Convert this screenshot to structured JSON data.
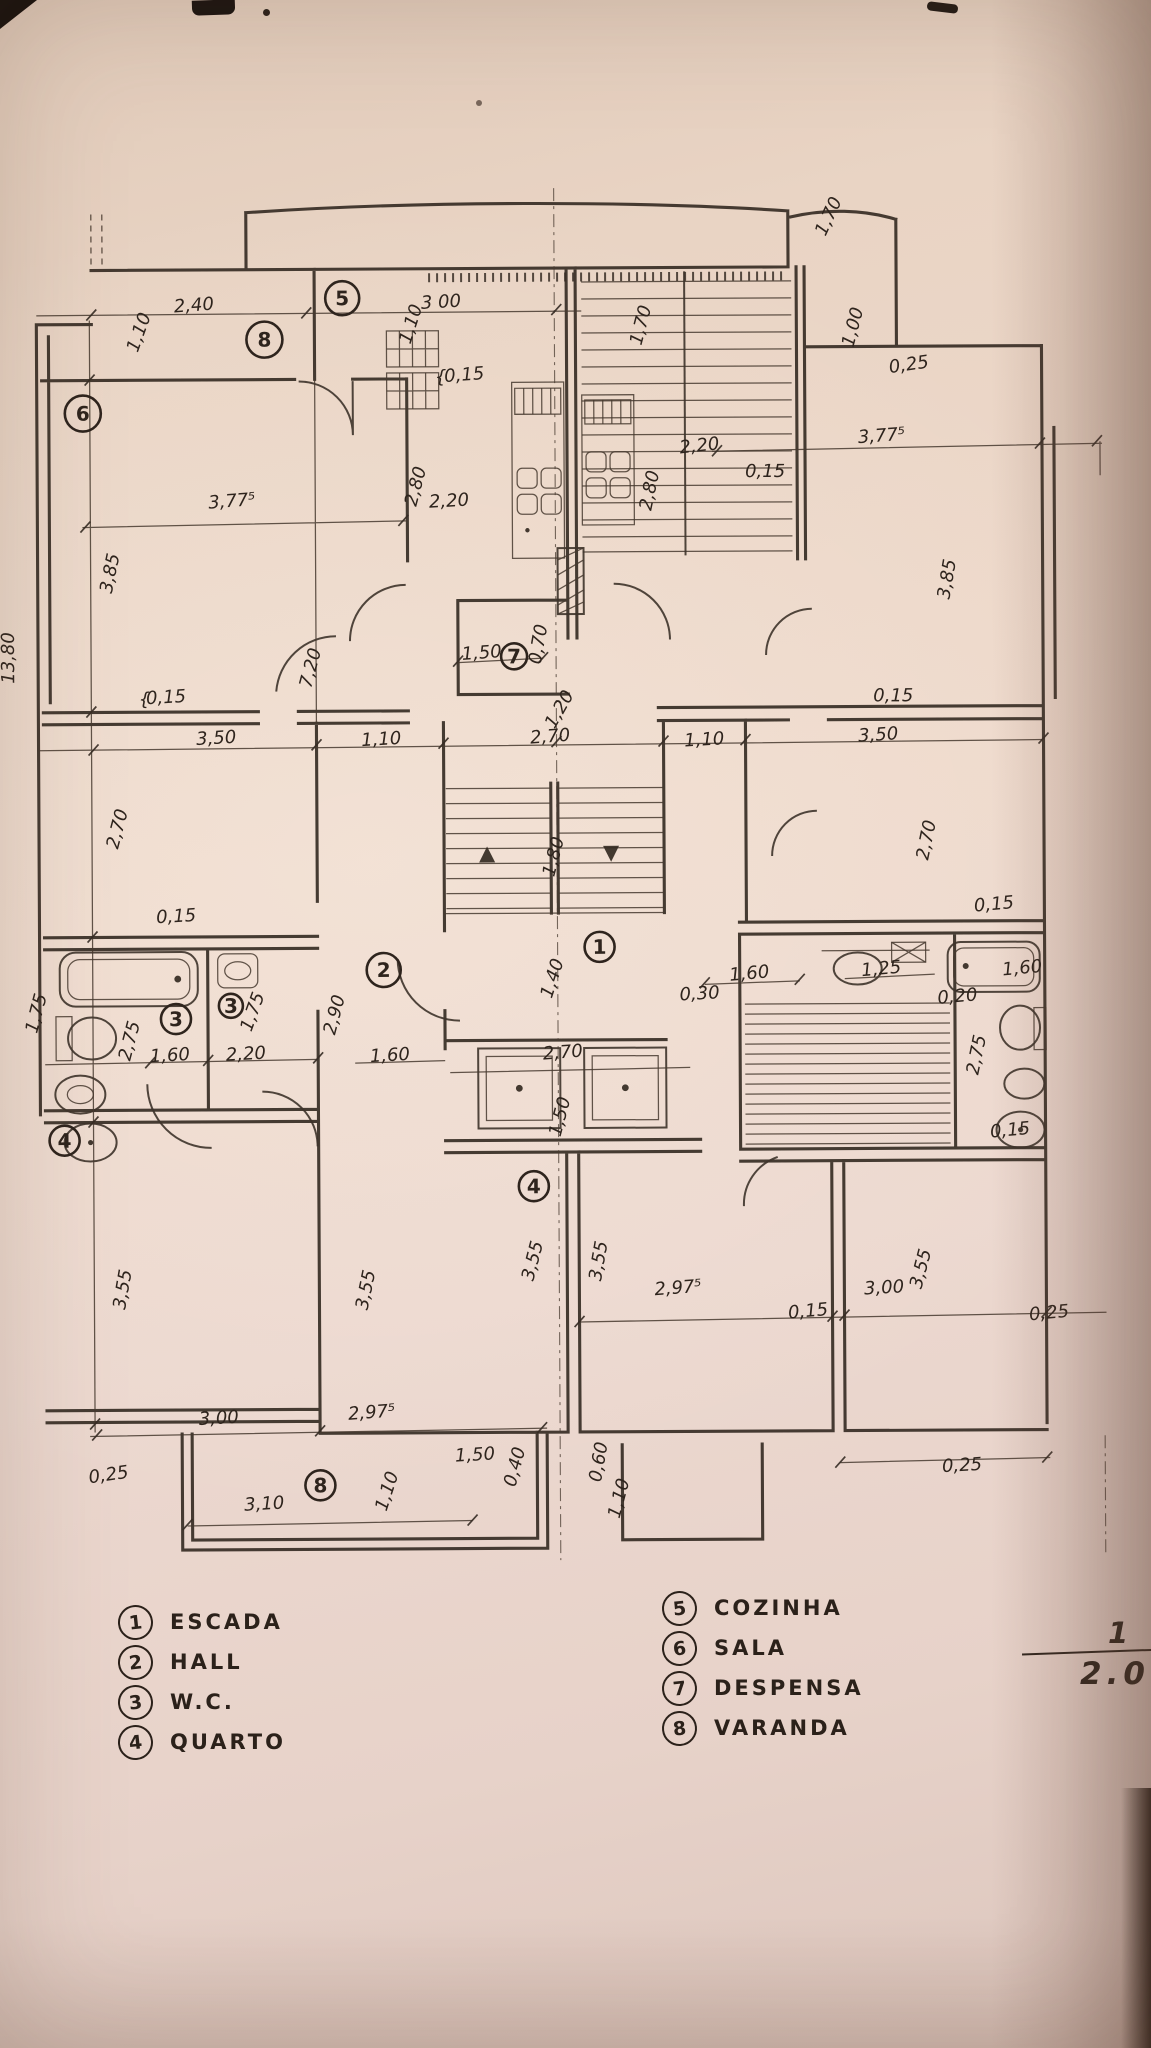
{
  "colors": {
    "paper": "#ecd8cb",
    "ink": "#342a22",
    "shadow": "#8a5f4e"
  },
  "legend": {
    "left": [
      {
        "num": "1",
        "label": "ESCADA"
      },
      {
        "num": "2",
        "label": "HALL"
      },
      {
        "num": "3",
        "label": "W.C."
      },
      {
        "num": "4",
        "label": "QUARTO"
      }
    ],
    "right": [
      {
        "num": "5",
        "label": "COZINHA"
      },
      {
        "num": "6",
        "label": "SALA"
      },
      {
        "num": "7",
        "label": "DESPENSA"
      },
      {
        "num": "8",
        "label": "VARANDA"
      }
    ]
  },
  "scale": {
    "numerator": "1",
    "denominator": "2.000"
  },
  "plan": {
    "room_markers": [
      {
        "num": "5",
        "x": 346,
        "y": 297,
        "s": 17
      },
      {
        "num": "8",
        "x": 268,
        "y": 338,
        "s": 18
      },
      {
        "num": "6",
        "x": 86,
        "y": 411,
        "s": 18
      },
      {
        "num": "7",
        "x": 516,
        "y": 656,
        "s": 13
      },
      {
        "num": "2",
        "x": 384,
        "y": 969,
        "s": 17
      },
      {
        "num": "1",
        "x": 600,
        "y": 947,
        "s": 15
      },
      {
        "num": "3",
        "x": 176,
        "y": 1017,
        "s": 15
      },
      {
        "num": "3",
        "x": 231,
        "y": 1004,
        "s": 12
      },
      {
        "num": "4",
        "x": 64,
        "y": 1138,
        "s": 15
      },
      {
        "num": "4",
        "x": 533,
        "y": 1186,
        "s": 15
      },
      {
        "num": "8",
        "x": 318,
        "y": 1484,
        "s": 15
      }
    ],
    "dim_labels": [
      {
        "t": "2,40",
        "x": 198,
        "y": 309,
        "r": -4
      },
      {
        "t": "3 00",
        "x": 445,
        "y": 307,
        "r": -3
      },
      {
        "t": "1,10",
        "x": 148,
        "y": 332,
        "r": -70
      },
      {
        "t": "1,10",
        "x": 420,
        "y": 325,
        "r": -72
      },
      {
        "t": "{",
        "x": 444,
        "y": 382,
        "r": 0,
        "fs": 28
      },
      {
        "t": "0,15",
        "x": 468,
        "y": 380,
        "r": -4
      },
      {
        "t": "1,70",
        "x": 650,
        "y": 327,
        "r": -75
      },
      {
        "t": "1,70",
        "x": 838,
        "y": 220,
        "r": -65
      },
      {
        "t": "1,00",
        "x": 862,
        "y": 330,
        "r": -75
      },
      {
        "t": "0,25",
        "x": 913,
        "y": 372,
        "r": -8
      },
      {
        "t": "3,77⁵",
        "x": 235,
        "y": 505,
        "r": -4
      },
      {
        "t": "3,77⁵",
        "x": 885,
        "y": 443,
        "r": -4
      },
      {
        "t": "2,20",
        "x": 452,
        "y": 506,
        "r": -3
      },
      {
        "t": "2,20",
        "x": 703,
        "y": 452,
        "r": -6
      },
      {
        "t": "2,80",
        "x": 424,
        "y": 487,
        "r": -75
      },
      {
        "t": "2,80",
        "x": 658,
        "y": 492,
        "r": -78
      },
      {
        "t": "0,15",
        "x": 768,
        "y": 478,
        "r": 0
      },
      {
        "t": "3,85",
        "x": 118,
        "y": 572,
        "r": -78
      },
      {
        "t": "3,85",
        "x": 955,
        "y": 582,
        "r": -80
      },
      {
        "t": "1,50",
        "x": 484,
        "y": 658,
        "r": -4
      },
      {
        "t": "0,70",
        "x": 546,
        "y": 645,
        "r": -80
      },
      {
        "t": "1,20",
        "x": 566,
        "y": 712,
        "r": -60
      },
      {
        "t": "{",
        "x": 146,
        "y": 703,
        "r": 0,
        "fs": 24
      },
      {
        "t": "0,15",
        "x": 168,
        "y": 701,
        "r": -3
      },
      {
        "t": "0,15",
        "x": 895,
        "y": 703,
        "r": 0
      },
      {
        "t": "3,50",
        "x": 218,
        "y": 742,
        "r": -3
      },
      {
        "t": "1,10",
        "x": 383,
        "y": 744,
        "r": -3
      },
      {
        "t": "2,70",
        "x": 552,
        "y": 742,
        "r": -4
      },
      {
        "t": "1,10",
        "x": 706,
        "y": 746,
        "r": -3
      },
      {
        "t": "3,50",
        "x": 880,
        "y": 742,
        "r": -3
      },
      {
        "t": "7,20",
        "x": 318,
        "y": 668,
        "r": -75
      },
      {
        "t": "2,70",
        "x": 124,
        "y": 828,
        "r": -75
      },
      {
        "t": "2,70",
        "x": 933,
        "y": 843,
        "r": -78
      },
      {
        "t": "1,80",
        "x": 560,
        "y": 858,
        "r": -75
      },
      {
        "t": "0,15",
        "x": 177,
        "y": 920,
        "r": -3
      },
      {
        "t": "0,15",
        "x": 995,
        "y": 912,
        "r": -5
      },
      {
        "t": "1,40",
        "x": 558,
        "y": 980,
        "r": -72
      },
      {
        "t": "0,30",
        "x": 700,
        "y": 1000,
        "r": -3
      },
      {
        "t": "1,60",
        "x": 750,
        "y": 980,
        "r": -5
      },
      {
        "t": "1,25",
        "x": 882,
        "y": 976,
        "r": -5
      },
      {
        "t": "1,60",
        "x": 1023,
        "y": 976,
        "r": -5
      },
      {
        "t": "0,20",
        "x": 958,
        "y": 1004,
        "r": -5
      },
      {
        "t": "2,75",
        "x": 135,
        "y": 1040,
        "r": -75
      },
      {
        "t": "1,75",
        "x": 42,
        "y": 1012,
        "r": -75
      },
      {
        "t": "1,75",
        "x": 258,
        "y": 1012,
        "r": -70
      },
      {
        "t": "1,60",
        "x": 170,
        "y": 1059,
        "r": -3
      },
      {
        "t": "2,20",
        "x": 246,
        "y": 1058,
        "r": -3
      },
      {
        "t": "2,90",
        "x": 340,
        "y": 1015,
        "r": -75
      },
      {
        "t": "1,60",
        "x": 390,
        "y": 1060,
        "r": -3
      },
      {
        "t": "2,70",
        "x": 563,
        "y": 1058,
        "r": -4
      },
      {
        "t": "1,50",
        "x": 565,
        "y": 1118,
        "r": -75
      },
      {
        "t": "2,75",
        "x": 982,
        "y": 1058,
        "r": -78
      },
      {
        "t": "0,15",
        "x": 1010,
        "y": 1138,
        "r": -5
      },
      {
        "t": "13,80",
        "x": 16,
        "y": 655,
        "r": -90
      },
      {
        "t": "3,55",
        "x": 127,
        "y": 1288,
        "r": -80
      },
      {
        "t": "3,55",
        "x": 370,
        "y": 1290,
        "r": -78
      },
      {
        "t": "3,55",
        "x": 537,
        "y": 1262,
        "r": -75
      },
      {
        "t": "3,55",
        "x": 603,
        "y": 1262,
        "r": -80
      },
      {
        "t": "3,55",
        "x": 925,
        "y": 1272,
        "r": -75
      },
      {
        "t": "2,97⁵",
        "x": 677,
        "y": 1294,
        "r": -4
      },
      {
        "t": "3,00",
        "x": 883,
        "y": 1295,
        "r": -3
      },
      {
        "t": "0,15",
        "x": 807,
        "y": 1318,
        "r": -5
      },
      {
        "t": "0,25",
        "x": 1048,
        "y": 1321,
        "r": -5
      },
      {
        "t": "3,00",
        "x": 217,
        "y": 1422,
        "r": -3
      },
      {
        "t": "2,97⁵",
        "x": 370,
        "y": 1417,
        "r": -4
      },
      {
        "t": "0,25",
        "x": 107,
        "y": 1478,
        "r": -8
      },
      {
        "t": "1,10",
        "x": 390,
        "y": 1492,
        "r": -72
      },
      {
        "t": "3,10",
        "x": 262,
        "y": 1508,
        "r": -3
      },
      {
        "t": "1,50",
        "x": 473,
        "y": 1460,
        "r": -3
      },
      {
        "t": "0,40",
        "x": 518,
        "y": 1468,
        "r": -75
      },
      {
        "t": "1,10",
        "x": 622,
        "y": 1500,
        "r": -75
      },
      {
        "t": "0,60",
        "x": 602,
        "y": 1463,
        "r": -80
      },
      {
        "t": "0,25",
        "x": 960,
        "y": 1473,
        "r": -3
      }
    ]
  }
}
